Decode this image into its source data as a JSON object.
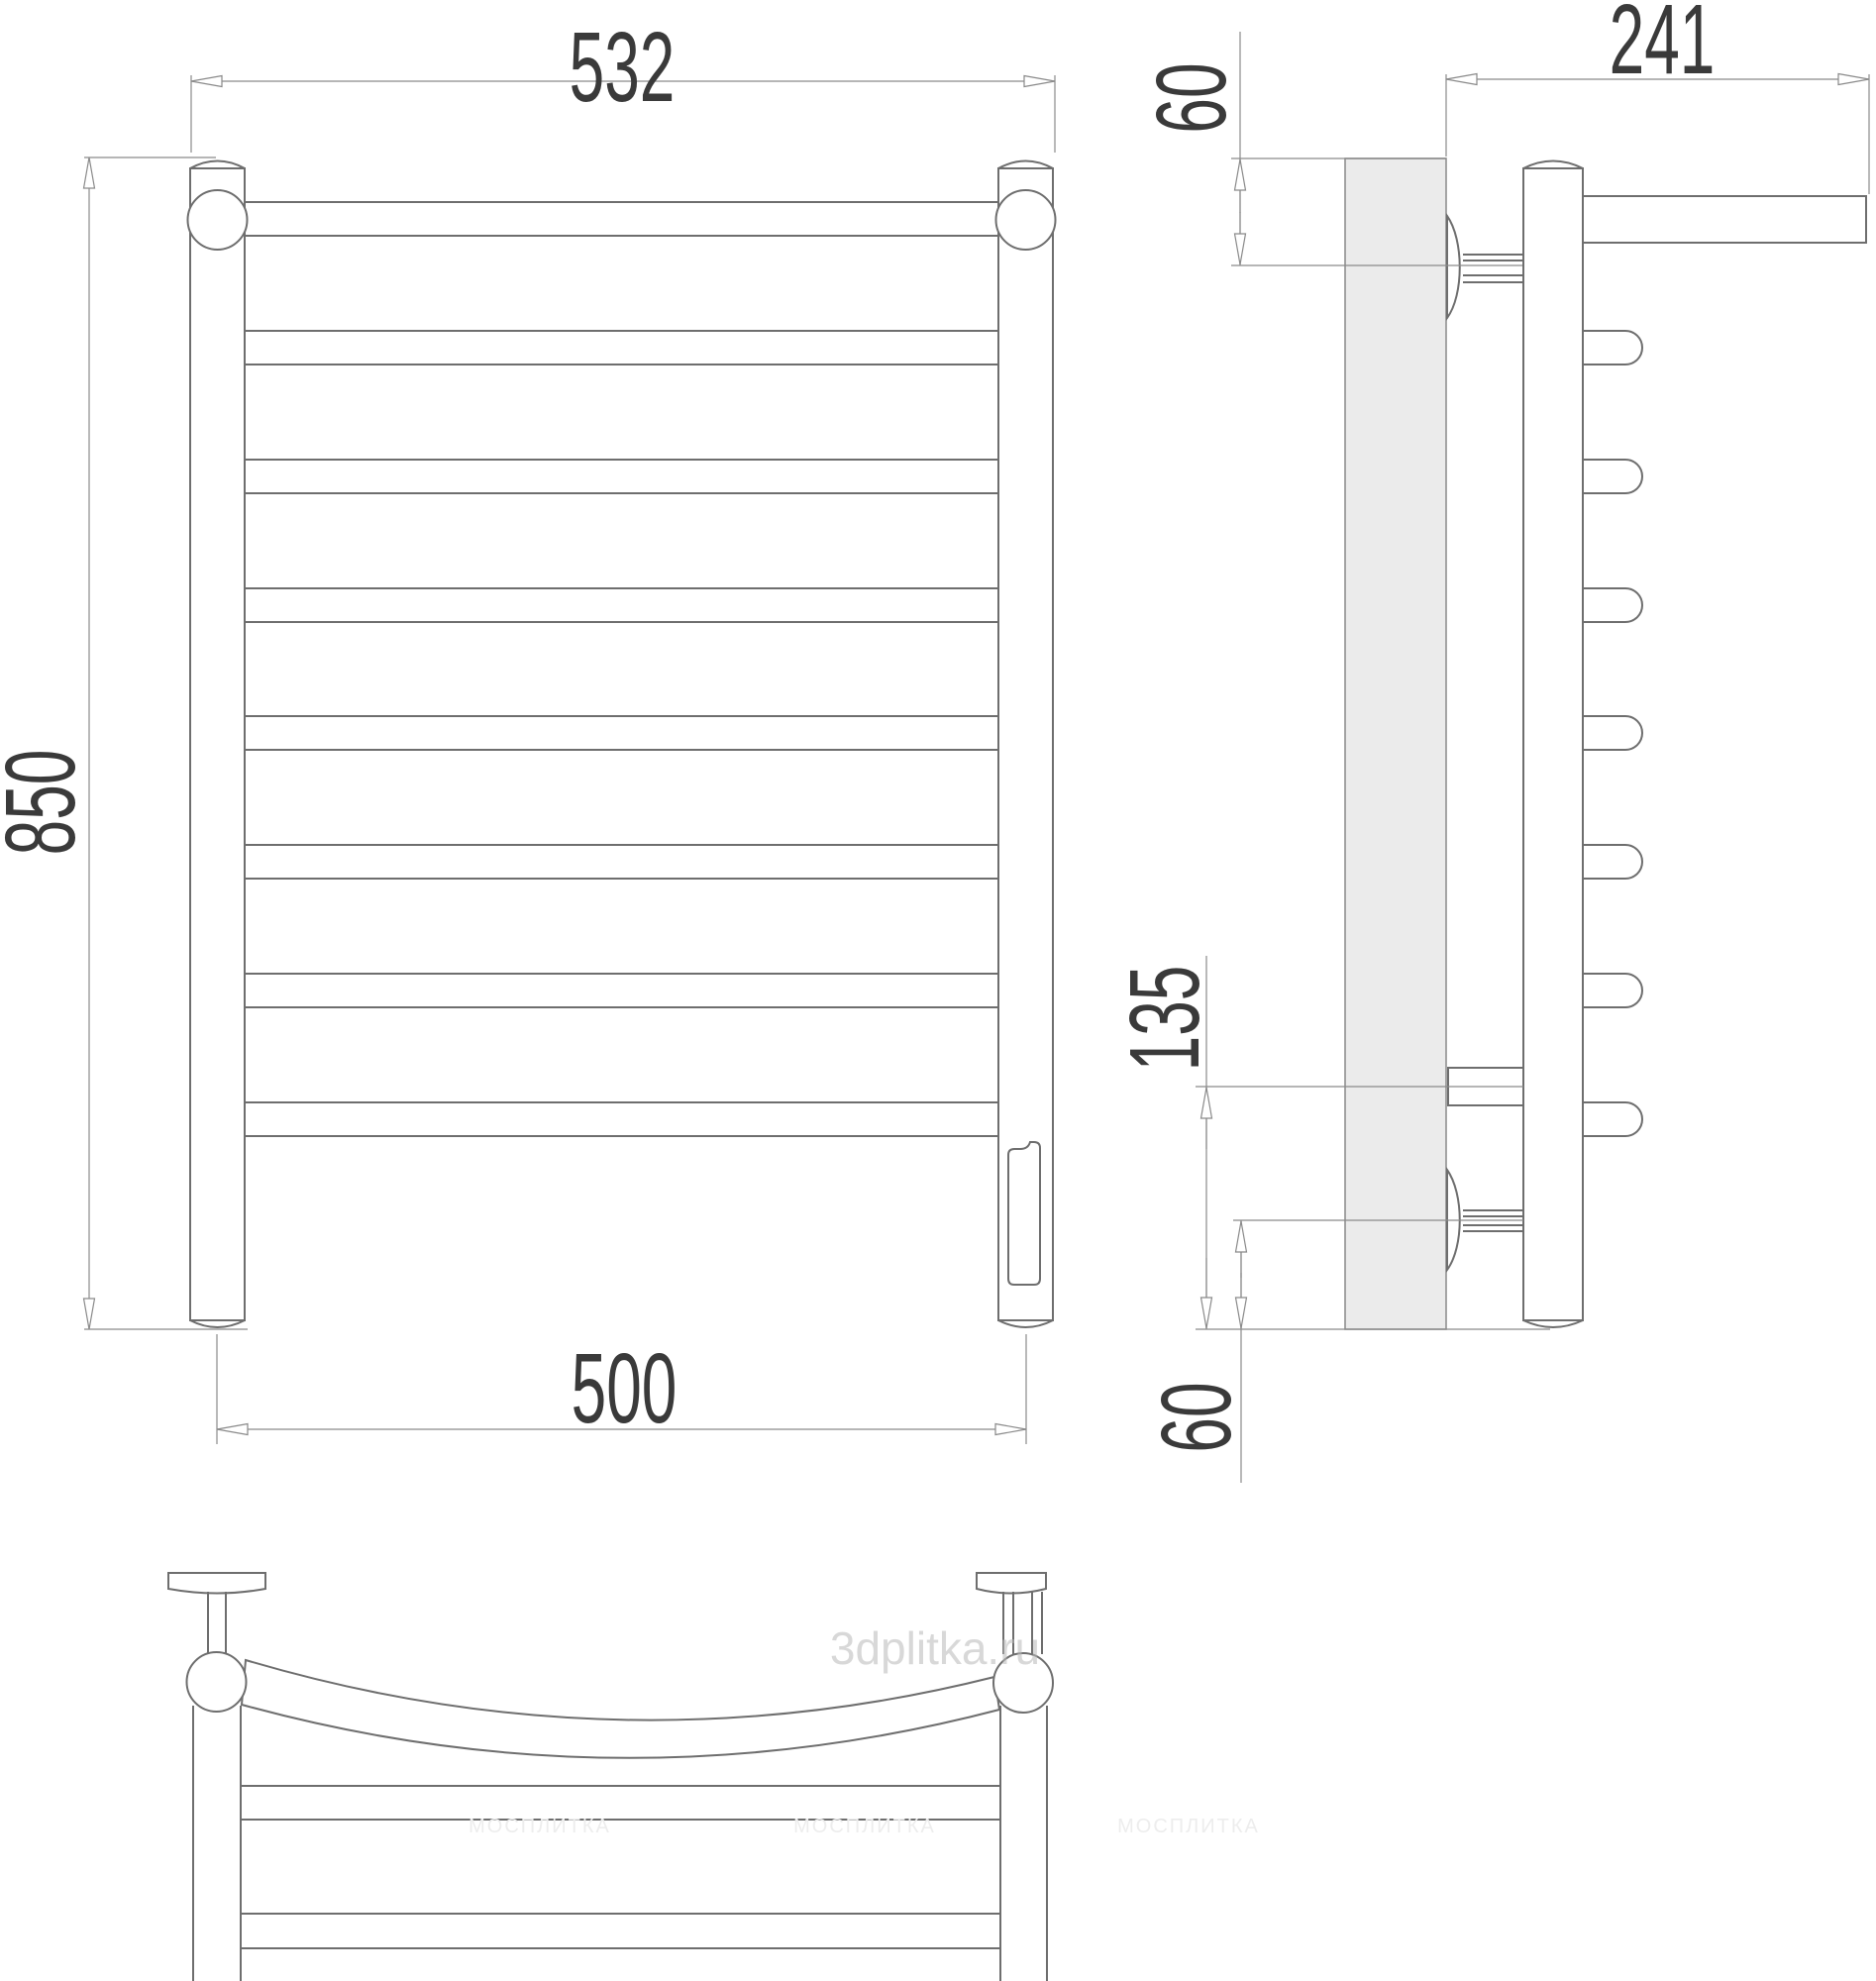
{
  "drawing": {
    "title_semantic": "towel-rail-technical-drawing",
    "dimensions": {
      "front_width_top": "532",
      "front_height": "850",
      "front_width_bottom": "500",
      "side_depth": "241",
      "side_top_offset": "60",
      "side_connection_height": "135",
      "side_bottom_offset": "60"
    },
    "watermarks": {
      "main": "3dplitka.ru",
      "tiled": "МОСПЛИТКА"
    },
    "colors": {
      "background": "#ffffff",
      "outline": "#6e6e6e",
      "dimension_line": "#8a8a8a",
      "dimension_text": "#3a3a3a",
      "wall_fill": "#ebebeb",
      "watermark": "#b9b9b9"
    }
  }
}
